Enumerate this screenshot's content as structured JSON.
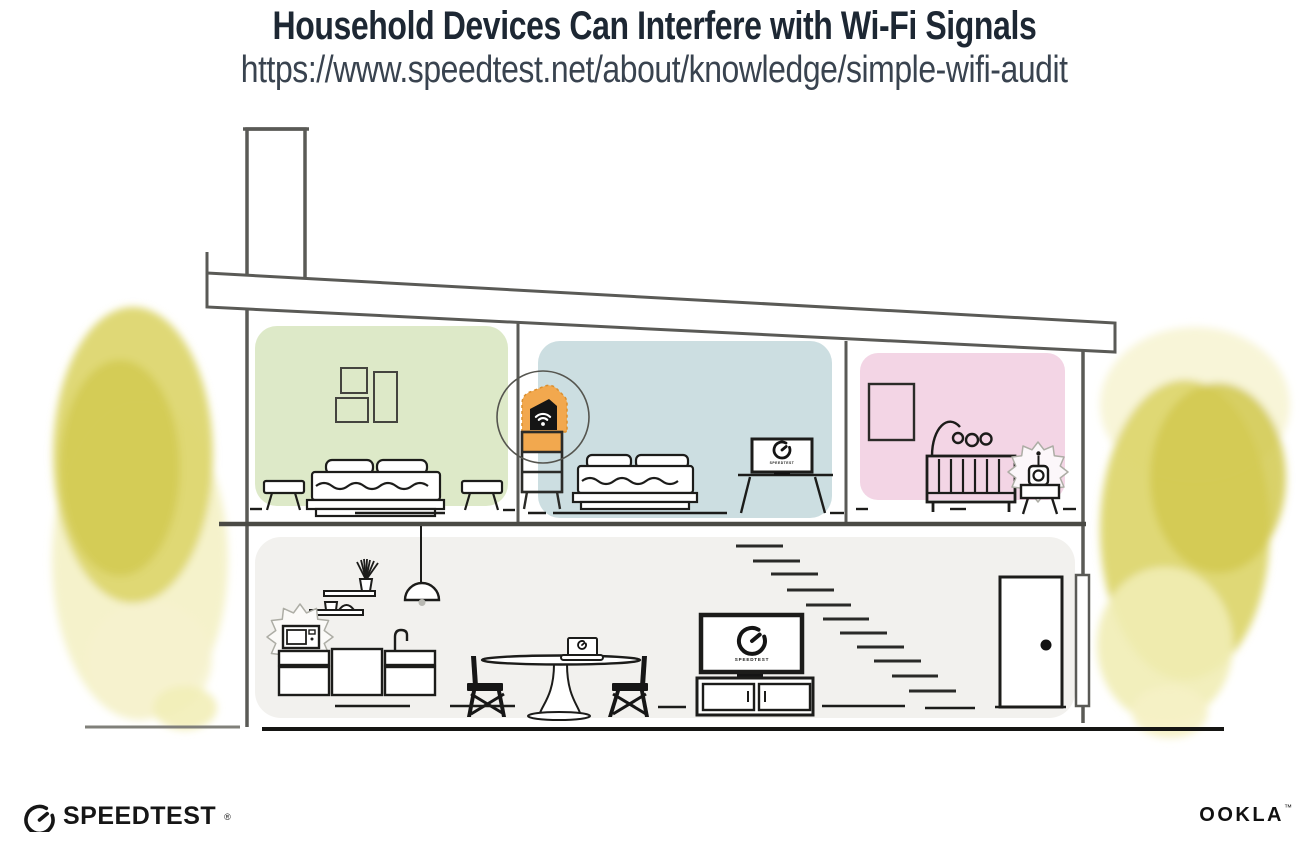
{
  "header": {
    "title": "Household Devices Can Interfere with Wi-Fi Signals",
    "url": "https://www.speedtest.net/about/knowledge/simple-wifi-audit"
  },
  "illustration": {
    "tv_screen_text": "SPEEDTEST",
    "bedroom_monitor_text": "SPEEDTEST",
    "icons": {
      "router": "wifi-router-icon",
      "tv": "speedometer-icon",
      "monitor": "speedometer-icon",
      "laptop": "speedometer-icon",
      "microwave": "microwave-icon",
      "baby_monitor": "baby-monitor-icon"
    },
    "colors": {
      "accent_orange": "#F2A84E",
      "accent_orange_edge": "#DB8F2E",
      "bedroom_left_green": "#DDE9C8",
      "bedroom_center_blue": "#CCDEE1",
      "nursery_pink": "#F3D5E5",
      "lower_floor_gray": "#F2F1EE",
      "foliage_yellow_main": "#DDD66F",
      "foliage_yellow_dark": "#D2C94F",
      "foliage_yellow_light": "#F3F0C2",
      "structure_gray": "#5A5A56",
      "line_black": "#1C1C1A"
    }
  },
  "footer": {
    "speedtest_label": "SPEEDTEST",
    "speedtest_mark": "®",
    "ookla_label": "OOKLA",
    "ookla_mark": "™"
  }
}
